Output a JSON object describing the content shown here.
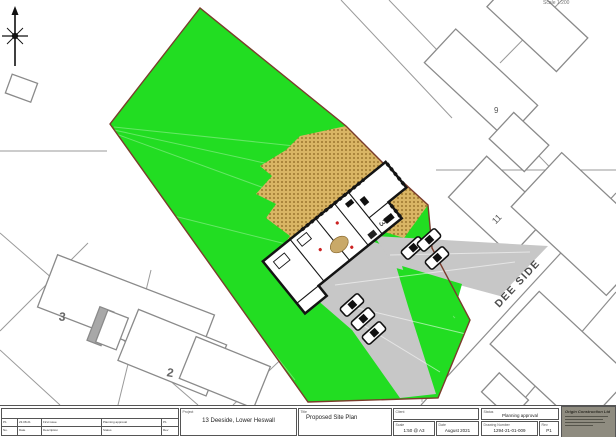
{
  "map": {
    "scale_note": "Scale 1:200",
    "road_label": "DEE SIDE",
    "plots": {
      "p9": "9",
      "p11": "11",
      "p3": "3",
      "p2": "2"
    },
    "building_label": "3",
    "colors": {
      "site_green": "#22dd22",
      "boundary": "#7a3c2c",
      "patio": "#d9b564",
      "patio_dot": "#8a651f",
      "drive": "#c7c7c7",
      "parcel_line": "#9a9a9a"
    }
  },
  "title_block": {
    "labels": {
      "project": "Project",
      "title": "Title",
      "client": "Client",
      "scale": "Scale",
      "date": "Date",
      "status": "Status",
      "drawing_number": "Drawing Number",
      "rev": "Rev"
    },
    "project": "13 Deeside, Lower Heswall",
    "title": "Proposed Site Plan",
    "client": "",
    "scale": "1:50 @ A3",
    "date": "August 2021",
    "status": "Planning approval",
    "drawing_number": "1294-21-01-009",
    "rev": "P1",
    "company": "Origin Construction Ltd",
    "revision_table": {
      "rows": [
        [
          "P1",
          "23.08.21",
          "First issue",
          "Planning approval",
          "P1"
        ],
        [
          "No.",
          "Date",
          "Description",
          "Status",
          "Rev"
        ]
      ]
    }
  }
}
